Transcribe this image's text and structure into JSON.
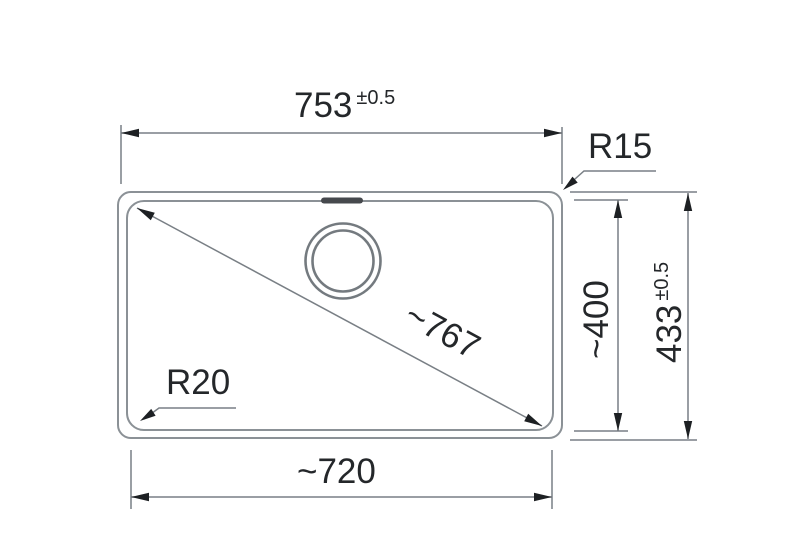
{
  "dimensions": {
    "outer_width": {
      "value": "753",
      "tolerance": "±0.5"
    },
    "outer_height": {
      "value": "433",
      "tolerance": "±0.5"
    },
    "inner_width": {
      "label": "~720"
    },
    "inner_height": {
      "label": "~400"
    },
    "diagonal": {
      "label": "~767"
    },
    "outer_corner_radius": {
      "label": "R15"
    },
    "inner_corner_radius": {
      "label": "R20"
    }
  },
  "colors": {
    "background": "#ffffff",
    "outline": "#8b9196",
    "dimension_line": "#797f85",
    "arrowhead": "#1d2023",
    "text": "#24272a"
  }
}
